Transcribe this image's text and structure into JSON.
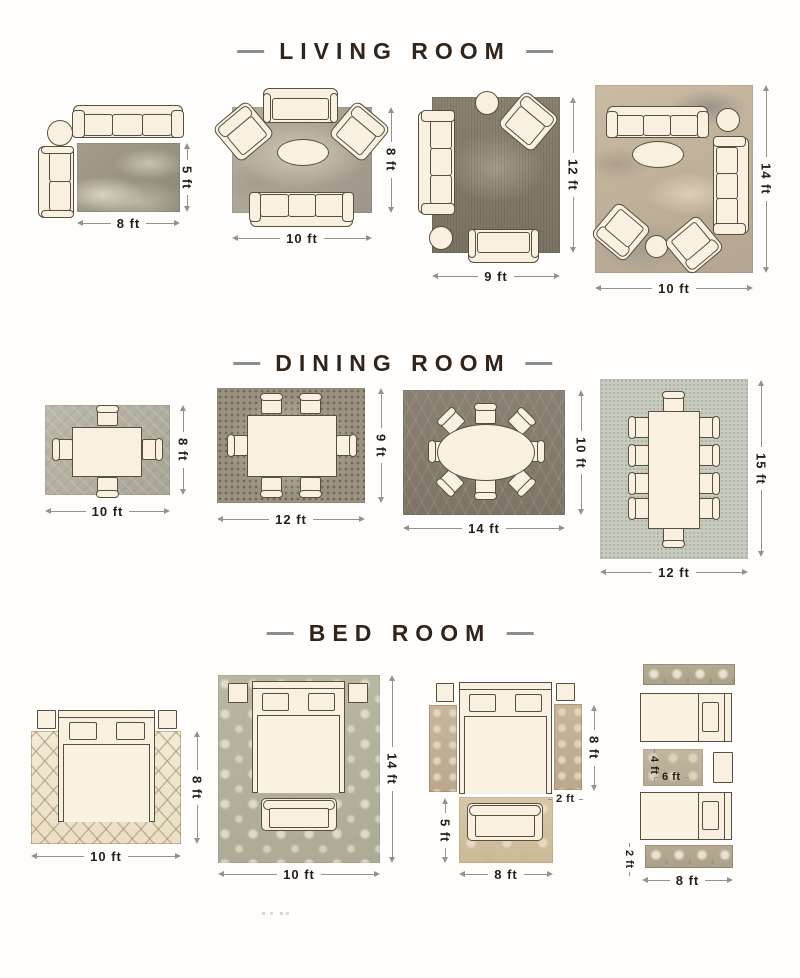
{
  "page_title": "Rug size guide by room",
  "colors": {
    "furniture_fill": "#f9f0e1",
    "furniture_outline": "#55503e",
    "title_text": "#33241a",
    "dimension_text": "#241e16",
    "dimension_line": "#969288",
    "background": "#fffefd"
  },
  "sections": [
    {
      "title": "LIVING ROOM",
      "layouts": [
        {
          "id": "living-1",
          "width_label": "8 ft",
          "height_label": "5 ft"
        },
        {
          "id": "living-2",
          "width_label": "10 ft",
          "height_label": "8 ft"
        },
        {
          "id": "living-3",
          "width_label": "9 ft",
          "height_label": "12 ft"
        },
        {
          "id": "living-4",
          "width_label": "10 ft",
          "height_label": "14 ft"
        }
      ]
    },
    {
      "title": "DINING ROOM",
      "layouts": [
        {
          "id": "dining-1",
          "width_label": "10 ft",
          "height_label": "8 ft"
        },
        {
          "id": "dining-2",
          "width_label": "12 ft",
          "height_label": "9 ft"
        },
        {
          "id": "dining-3",
          "width_label": "14 ft",
          "height_label": "10 ft"
        },
        {
          "id": "dining-4",
          "width_label": "12 ft",
          "height_label": "15 ft"
        }
      ]
    },
    {
      "title": "BED ROOM",
      "layouts": [
        {
          "id": "bed-1",
          "width_label": "10 ft",
          "height_label": "8 ft"
        },
        {
          "id": "bed-2",
          "width_label": "10 ft",
          "height_label": "14 ft"
        },
        {
          "id": "bed-3",
          "width_label": "8 ft",
          "runner_length_label": "8 ft",
          "runner_width_label": "2 ft",
          "foot_rug_height_label": "5 ft"
        },
        {
          "id": "bed-4",
          "width_label": "8 ft",
          "runner_height_label": "2 ft",
          "middle_rug_width_label": "6 ft",
          "middle_rug_height_label": "4 ft"
        }
      ]
    }
  ]
}
